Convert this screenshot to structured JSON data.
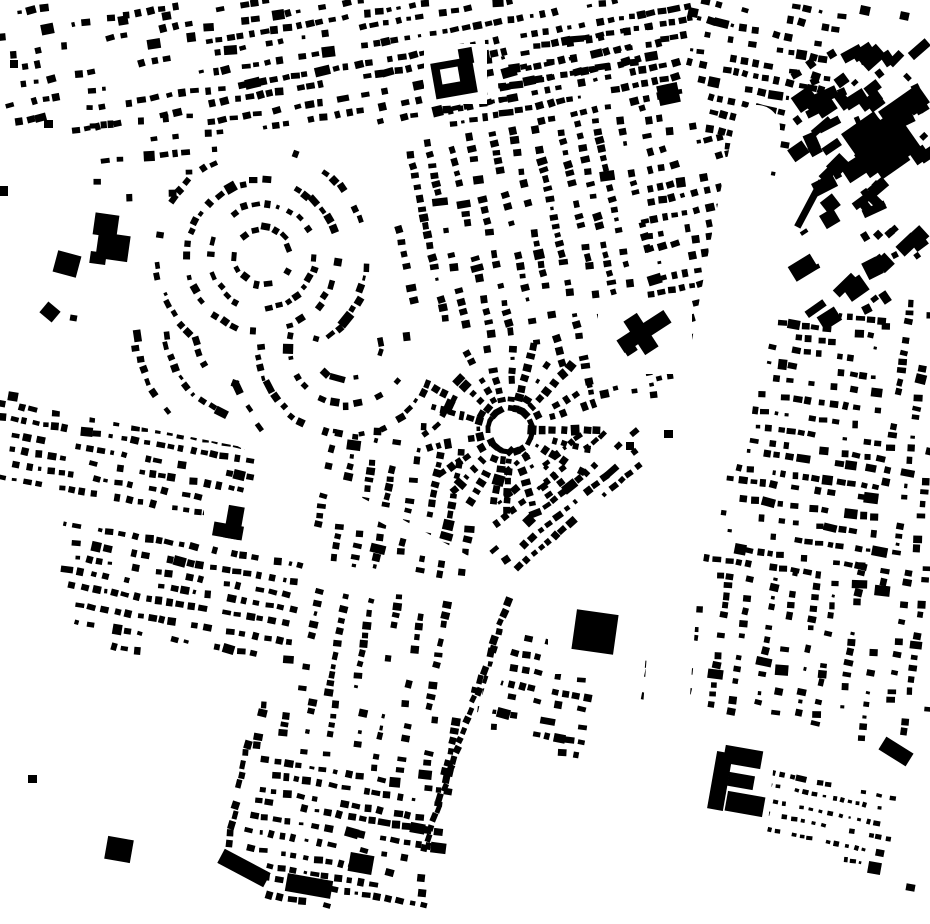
{
  "map": {
    "width": 930,
    "height": 924,
    "seed": 42,
    "colors": {
      "ink": "#000000",
      "paper": "#ffffff"
    },
    "defaults": {
      "bw": 7.2,
      "bh": 6.2,
      "pitch": 11,
      "row_gap": 15.5,
      "skip": 0.27
    },
    "districts": [
      {
        "n": "top-left-sparse",
        "m": "rows",
        "p": [
          [
            0,
            0
          ],
          [
            200,
            0
          ],
          [
            205,
            126
          ],
          [
            60,
            132
          ],
          [
            0,
            118
          ]
        ],
        "a": -10,
        "sk": 0.52,
        "rg": 17,
        "pt": 12
      },
      {
        "n": "top-strip",
        "m": "rows",
        "p": [
          [
            202,
            0
          ],
          [
            695,
            0
          ],
          [
            690,
            46
          ],
          [
            445,
            118
          ],
          [
            208,
            133
          ]
        ],
        "a": -10,
        "sk": 0.24,
        "rg": 15,
        "pt": 11
      },
      {
        "n": "ne-rows-top",
        "m": "rows",
        "p": [
          [
            442,
            58
          ],
          [
            692,
            4
          ],
          [
            680,
            98
          ],
          [
            452,
            136
          ]
        ],
        "a": -12,
        "sk": 0.24,
        "rg": 15,
        "pt": 11
      },
      {
        "n": "tr-corner-rows",
        "m": "rows",
        "p": [
          [
            694,
            0
          ],
          [
            848,
            0
          ],
          [
            836,
            62
          ],
          [
            768,
            188
          ],
          [
            698,
            118
          ],
          [
            686,
            40
          ]
        ],
        "a": 12,
        "sk": 0.3,
        "rg": 15,
        "pt": 11
      },
      {
        "n": "ne-rows-east",
        "m": "rows",
        "p": [
          [
            640,
            104
          ],
          [
            762,
            150
          ],
          [
            700,
            378
          ],
          [
            652,
            400
          ]
        ],
        "a": -12,
        "sk": 0.26,
        "rg": 15,
        "pt": 11
      },
      {
        "n": "ne-cols",
        "m": "cols",
        "p": [
          [
            398,
            146
          ],
          [
            642,
            108
          ],
          [
            656,
            400
          ],
          [
            585,
            392
          ],
          [
            540,
            350
          ],
          [
            470,
            332
          ],
          [
            398,
            300
          ]
        ],
        "a": -12,
        "sk": 0.28,
        "rg": 21,
        "pt": 10
      },
      {
        "n": "crescent-main",
        "m": "arc",
        "cx": 262,
        "cy": 256,
        "r0": 28,
        "r1": 134,
        "gp": 26,
        "pt": 11,
        "sk": 0.3,
        "clip": [
          [
            118,
            170
          ],
          [
            398,
            136
          ],
          [
            398,
            338
          ],
          [
            118,
            338
          ]
        ]
      },
      {
        "n": "crescent-se",
        "m": "arc",
        "cx": 348,
        "cy": 346,
        "r0": 34,
        "r1": 120,
        "gp": 26,
        "pt": 11,
        "sk": 0.35,
        "clip": [
          [
            234,
            332
          ],
          [
            462,
            332
          ],
          [
            462,
            434
          ],
          [
            234,
            434
          ]
        ]
      },
      {
        "n": "crescent-sw",
        "m": "arc",
        "cx": 252,
        "cy": 330,
        "r0": 58,
        "r1": 142,
        "gp": 25,
        "pt": 11,
        "sk": 0.35,
        "a0": 85,
        "a1": 200,
        "clip": [
          [
            60,
            332
          ],
          [
            236,
            332
          ],
          [
            236,
            415
          ],
          [
            60,
            415
          ]
        ]
      },
      {
        "n": "upper-left-sparse",
        "m": "rows",
        "p": [
          [
            86,
            96
          ],
          [
            232,
            120
          ],
          [
            232,
            184
          ],
          [
            92,
            208
          ]
        ],
        "a": -6,
        "sk": 0.5,
        "rg": 17,
        "pt": 12
      },
      {
        "n": "radial-fan",
        "m": "radial",
        "cx": 510,
        "cy": 430,
        "r0": 22,
        "r1": 90,
        "ss": 15,
        "pt": 10,
        "sk": 0.22,
        "clip": [
          [
            428,
            345
          ],
          [
            592,
            345
          ],
          [
            612,
            430
          ],
          [
            582,
            522
          ],
          [
            448,
            522
          ],
          [
            418,
            428
          ]
        ]
      },
      {
        "n": "fan-se-rows",
        "m": "rows",
        "p": [
          [
            505,
            450
          ],
          [
            640,
            425
          ],
          [
            645,
            470
          ],
          [
            530,
            570
          ],
          [
            488,
            558
          ]
        ],
        "a": -40,
        "sk": 0.28,
        "rg": 16,
        "pt": 10
      },
      {
        "n": "sw-cols",
        "m": "cols",
        "p": [
          [
            318,
            424
          ],
          [
            480,
            444
          ],
          [
            464,
            584
          ],
          [
            312,
            562
          ]
        ],
        "a": 10,
        "sk": 0.32,
        "rg": 22,
        "pt": 10
      },
      {
        "n": "left-mid-rows",
        "m": "rows",
        "p": [
          [
            0,
            398
          ],
          [
            256,
            442
          ],
          [
            244,
            526
          ],
          [
            0,
            482
          ]
        ],
        "a": 10,
        "sk": 0.26,
        "rg": 15,
        "pt": 11
      },
      {
        "n": "left-lower-rows",
        "m": "rows",
        "p": [
          [
            58,
            520
          ],
          [
            302,
            562
          ],
          [
            292,
            676
          ],
          [
            70,
            640
          ]
        ],
        "a": 10,
        "sk": 0.27,
        "rg": 15,
        "pt": 11
      },
      {
        "n": "mid-cols",
        "m": "cols",
        "p": [
          [
            304,
            584
          ],
          [
            456,
            602
          ],
          [
            446,
            716
          ],
          [
            298,
            694
          ]
        ],
        "a": 10,
        "sk": 0.3,
        "rg": 22,
        "pt": 10
      },
      {
        "n": "bottom-central-cols",
        "m": "cols",
        "p": [
          [
            262,
            694
          ],
          [
            462,
            722
          ],
          [
            452,
            780
          ],
          [
            250,
            750
          ]
        ],
        "a": 10,
        "sk": 0.3,
        "rg": 22,
        "pt": 10
      },
      {
        "n": "bottom-central-rows",
        "m": "rows",
        "p": [
          [
            258,
            754
          ],
          [
            452,
            782
          ],
          [
            428,
            906
          ],
          [
            268,
            906
          ],
          [
            246,
            850
          ]
        ],
        "a": 10,
        "sk": 0.28,
        "rg": 15,
        "pt": 11
      },
      {
        "n": "se-small-rows",
        "m": "rows",
        "p": [
          [
            492,
            616
          ],
          [
            598,
            634
          ],
          [
            584,
            762
          ],
          [
            520,
            756
          ],
          [
            470,
            706
          ]
        ],
        "a": 10,
        "sk": 0.3,
        "rg": 15,
        "pt": 11
      },
      {
        "n": "wedge-rows",
        "m": "rows",
        "p": [
          [
            775,
            322
          ],
          [
            882,
            310
          ],
          [
            882,
            568
          ],
          [
            680,
            582
          ],
          [
            706,
            545
          ],
          [
            752,
            408
          ]
        ],
        "a": 8,
        "sk": 0.3,
        "rg": 15,
        "pt": 11
      },
      {
        "n": "wedge-cols",
        "m": "cols",
        "p": [
          [
            668,
            586
          ],
          [
            930,
            550
          ],
          [
            930,
            716
          ],
          [
            886,
            744
          ],
          [
            640,
            696
          ]
        ],
        "a": 8,
        "sk": 0.3,
        "rg": 21,
        "pt": 10
      },
      {
        "n": "right-edge-cols",
        "m": "cols",
        "p": [
          [
            884,
            306
          ],
          [
            930,
            300
          ],
          [
            930,
            546
          ],
          [
            884,
            562
          ]
        ],
        "a": 8,
        "sk": 0.3,
        "rg": 20,
        "pt": 10
      },
      {
        "n": "br-tiny-rows",
        "m": "rows",
        "p": [
          [
            770,
            768
          ],
          [
            896,
            788
          ],
          [
            884,
            878
          ],
          [
            758,
            826
          ]
        ],
        "a": 12,
        "sk": 0.3,
        "rg": 13,
        "pt": 8.5,
        "bw": 5,
        "bh": 4.2
      },
      {
        "n": "tr-cluster",
        "m": "cluster",
        "p": [
          [
            795,
            58
          ],
          [
            930,
            42
          ],
          [
            930,
            300
          ],
          [
            802,
            330
          ]
        ],
        "a": -35,
        "cnt": 95
      },
      {
        "n": "road-line-west",
        "m": "line",
        "x1": 248,
        "y1": 744,
        "x2": 228,
        "y2": 844,
        "pt": 10
      },
      {
        "n": "road-line-diag",
        "m": "line",
        "x1": 508,
        "y1": 602,
        "x2": 424,
        "y2": 848,
        "pt": 10
      }
    ],
    "streets": [
      {
        "n": "grand-avenue",
        "pts": [
          [
            757,
            128
          ],
          [
            737,
            225
          ],
          [
            706,
            390
          ],
          [
            674,
            600
          ],
          [
            650,
            924
          ]
        ],
        "w": 46
      },
      {
        "n": "sw-road",
        "pts": [
          [
            0,
            393
          ],
          [
            240,
            440
          ],
          [
            390,
            520
          ],
          [
            520,
            592
          ]
        ],
        "w": 13
      },
      {
        "n": "bottom-road",
        "pts": [
          [
            520,
            602
          ],
          [
            488,
            700
          ],
          [
            462,
            810
          ],
          [
            450,
            924
          ]
        ],
        "w": 14
      },
      {
        "n": "school-yard",
        "poly": [
          [
            424,
            44
          ],
          [
            487,
            44
          ],
          [
            487,
            104
          ],
          [
            424,
            104
          ]
        ]
      },
      {
        "n": "church-yard",
        "poly": [
          [
            598,
            298
          ],
          [
            692,
            298
          ],
          [
            692,
            374
          ],
          [
            598,
            374
          ]
        ]
      },
      {
        "n": "square-yard",
        "poly": [
          [
            548,
            586
          ],
          [
            642,
            586
          ],
          [
            642,
            674
          ],
          [
            548,
            674
          ]
        ]
      },
      {
        "n": "lbldg-yard",
        "poly": [
          [
            204,
            497
          ],
          [
            249,
            497
          ],
          [
            249,
            546
          ],
          [
            204,
            546
          ]
        ]
      },
      {
        "n": "ebldg-yard",
        "poly": [
          [
            702,
            740
          ],
          [
            775,
            750
          ],
          [
            768,
            824
          ],
          [
            698,
            814
          ]
        ]
      }
    ],
    "landmarks": [
      {
        "n": "school-main",
        "x": 433,
        "y": 60,
        "w": 42,
        "h": 36,
        "r": -10
      },
      {
        "n": "school-court",
        "x": 441,
        "y": 68,
        "w": 18,
        "h": 15,
        "r": -10,
        "f": "paper"
      },
      {
        "n": "school-tower",
        "x": 459,
        "y": 48,
        "w": 14,
        "h": 16,
        "r": -10
      },
      {
        "n": "church-nave",
        "x": 616,
        "y": 324,
        "w": 56,
        "h": 15,
        "r": -33
      },
      {
        "n": "church-transept",
        "x": 633,
        "y": 314,
        "w": 16,
        "h": 40,
        "r": -33
      },
      {
        "n": "church-annex",
        "x": 624,
        "y": 344,
        "w": 12,
        "h": 10,
        "r": -33
      },
      {
        "n": "big-square-bldg",
        "x": 574,
        "y": 612,
        "w": 42,
        "h": 40,
        "r": 8
      },
      {
        "n": "l-bldg-wing-v",
        "x": 226,
        "y": 506,
        "w": 16,
        "h": 33,
        "r": 10
      },
      {
        "n": "l-bldg-wing-h",
        "x": 213,
        "y": 524,
        "w": 30,
        "h": 14,
        "r": 10
      },
      {
        "n": "left-blob-a",
        "x": 94,
        "y": 214,
        "w": 24,
        "h": 22,
        "r": 8
      },
      {
        "n": "left-blob-b",
        "x": 97,
        "y": 234,
        "w": 32,
        "h": 26,
        "r": 8
      },
      {
        "n": "left-blob-c",
        "x": 90,
        "y": 252,
        "w": 16,
        "h": 12,
        "r": 8
      },
      {
        "n": "left-small-blob",
        "x": 55,
        "y": 253,
        "w": 24,
        "h": 22,
        "r": 15
      },
      {
        "n": "ne-square-bldg",
        "x": 658,
        "y": 84,
        "w": 21,
        "h": 20,
        "r": -12
      },
      {
        "n": "e-bldg-spine",
        "x": 712,
        "y": 752,
        "w": 16,
        "h": 58,
        "r": 10
      },
      {
        "n": "e-bldg-arm-a",
        "x": 724,
        "y": 748,
        "w": 38,
        "h": 18,
        "r": 10
      },
      {
        "n": "e-bldg-arm-b",
        "x": 728,
        "y": 774,
        "w": 26,
        "h": 14,
        "r": 10
      },
      {
        "n": "e-bldg-arm-c",
        "x": 726,
        "y": 794,
        "w": 38,
        "h": 20,
        "r": 10
      },
      {
        "n": "br-bar",
        "x": 880,
        "y": 744,
        "w": 32,
        "h": 15,
        "r": 32
      },
      {
        "n": "bl-square-bldg",
        "x": 106,
        "y": 838,
        "w": 26,
        "h": 23,
        "r": 10
      },
      {
        "n": "bottom-bar-a",
        "x": 218,
        "y": 860,
        "w": 52,
        "h": 16,
        "r": 28
      },
      {
        "n": "bottom-bar-b",
        "x": 286,
        "y": 877,
        "w": 46,
        "h": 18,
        "r": 10
      },
      {
        "n": "bottom-bar-c",
        "x": 349,
        "y": 854,
        "w": 24,
        "h": 19,
        "r": 10
      },
      {
        "n": "tr-t-bldg-a",
        "x": 880,
        "y": 96,
        "w": 48,
        "h": 22,
        "r": -35
      },
      {
        "n": "tr-t-bldg-b",
        "x": 888,
        "y": 112,
        "w": 22,
        "h": 46,
        "r": -35
      },
      {
        "n": "tr-t-bldg-c",
        "x": 858,
        "y": 140,
        "w": 44,
        "h": 28,
        "r": -35
      },
      {
        "n": "tr-t-bldg-d",
        "x": 912,
        "y": 148,
        "w": 16,
        "h": 14,
        "r": -35
      },
      {
        "n": "tr-big-a",
        "x": 846,
        "y": 120,
        "w": 40,
        "h": 30,
        "r": -35
      },
      {
        "n": "tr-big-b",
        "x": 872,
        "y": 146,
        "w": 34,
        "h": 26,
        "r": -35
      },
      {
        "n": "tr-thin-bar",
        "x": 806,
        "y": 178,
        "w": 7,
        "h": 52,
        "r": 28
      }
    ],
    "singles": [
      [
        8,
        392,
        10,
        9,
        10
      ],
      [
        42,
        305,
        16,
        14,
        40
      ],
      [
        70,
        315,
        7,
        6,
        10
      ],
      [
        0,
        186,
        8,
        10,
        0
      ],
      [
        28,
        775,
        9,
        8,
        0
      ],
      [
        10,
        60,
        8,
        8,
        0
      ],
      [
        44,
        120,
        9,
        8,
        0
      ],
      [
        118,
        16,
        10,
        9,
        -10
      ],
      [
        162,
        12,
        9,
        8,
        -10
      ],
      [
        860,
        6,
        10,
        9,
        12
      ],
      [
        900,
        12,
        9,
        8,
        12
      ],
      [
        688,
        8,
        10,
        9,
        12
      ],
      [
        664,
        430,
        9,
        8,
        0
      ],
      [
        626,
        442,
        8,
        8,
        0
      ],
      [
        600,
        390,
        9,
        8,
        -12
      ],
      [
        585,
        378,
        8,
        7,
        -12
      ],
      [
        906,
        884,
        9,
        7,
        10
      ],
      [
        868,
        862,
        13,
        12,
        10
      ]
    ]
  }
}
